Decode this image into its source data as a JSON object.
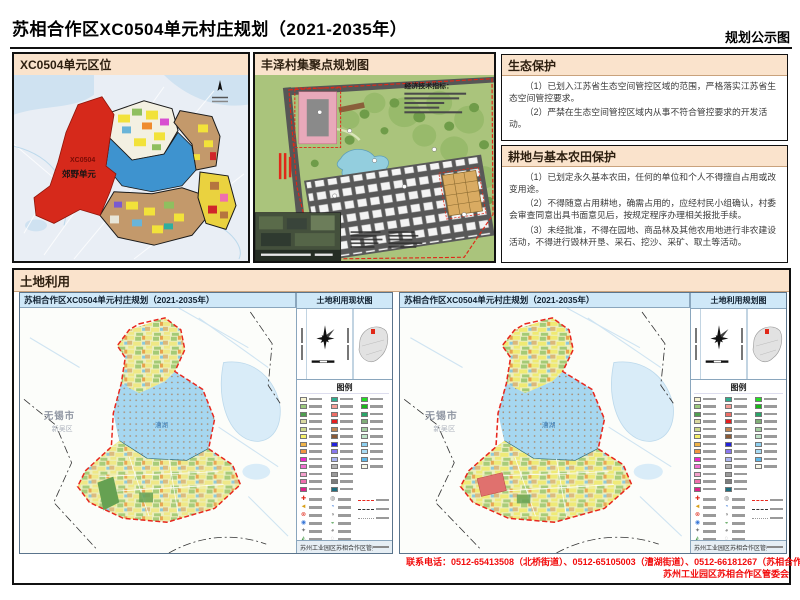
{
  "page": {
    "title": "苏相合作区XC0504单元村庄规划（2021-2035年）",
    "corner_label": "规划公示图"
  },
  "location_panel": {
    "title": "XC0504单元区位",
    "unit_label": "XC0504",
    "unit_sublabel": "郊野单元"
  },
  "fengze_panel": {
    "title": "丰泽村集聚点规划图",
    "indicator_title": "经济技术指标："
  },
  "eco_section": {
    "title": "生态保护",
    "paragraphs": [
      "（1）已划入江苏省生态空间管控区域的范围，严格落实江苏省生态空间管控要求。",
      "（2）严禁在生态空间管控区域内从事不符合管控要求的开发活动。"
    ]
  },
  "farmland_section": {
    "title": "耕地与基本农田保护",
    "paragraphs": [
      "（1）已划定永久基本农田，任何的单位和个人不得擅自占用或改变用途。",
      "（2）不得随意占用耕地，确需占用的，应经村民小组确认，村委会审查同意出具书面意见后，按规定程序办理相关报批手续。",
      "（3）未经批准，不得在园地、商品林及其他农用地进行非农建设活动，不得进行毁林开垦、采石、挖沙、采矿、取土等活动。"
    ]
  },
  "landuse_section": {
    "title": "土地利用",
    "maps": [
      {
        "title": "苏相合作区XC0504单元村庄规划（2021-2035年）",
        "corner_label": "土地利用现状图",
        "city_label": "无锡市",
        "district_label": "新吴区",
        "lake_label": "漕湖",
        "footer_text": "苏州工业园区苏相合作区管委会"
      },
      {
        "title": "苏相合作区XC0504单元村庄规划（2021-2035年）",
        "corner_label": "土地利用规划图",
        "city_label": "无锡市",
        "district_label": "新吴区",
        "lake_label": "漕湖",
        "footer_text": "苏州工业园区苏相合作区管委会"
      }
    ],
    "legend": {
      "title": "图例",
      "col1": [
        "#f7f3cf",
        "#9cc97e",
        "#4f9e50",
        "#d9d9a0",
        "#cdd98a",
        "#f5f06a",
        "#f0b44a",
        "#f2953f",
        "#ee28c8",
        "#f06fd0",
        "#f3a0cc",
        "#ef6fae",
        "#e0218a"
      ],
      "col2": [
        "#2fae8f",
        "#f59d96",
        "#ef6e66",
        "#e51f1f",
        "#c08552",
        "#8a5a36",
        "#2222dd",
        "#8877ee",
        "#aab4f0",
        "#b3b3b3",
        "#9a9a9a",
        "#7d7d7d",
        "#1f6f80"
      ],
      "col3": [
        "#22e022",
        "#18b818",
        "#29a568",
        "#7fae77",
        "#a4cfa0",
        "#bfe3c8",
        "#8ed0f0",
        "#a9dcf5",
        "#5fb8e8",
        "#f7f7e8"
      ],
      "point_symbols": [
        {
          "glyph": "✚",
          "color": "#e02818"
        },
        {
          "glyph": "◄",
          "color": "#d8a018"
        },
        {
          "glyph": "⊗",
          "color": "#e02818"
        },
        {
          "glyph": "◉",
          "color": "#3a78d8"
        },
        {
          "glyph": "✦",
          "color": "#777777"
        },
        {
          "glyph": "◭",
          "color": "#4a9a4a"
        }
      ],
      "point_symbols2": [
        {
          "glyph": "◍",
          "color": "#888888"
        },
        {
          "glyph": "◔",
          "color": "#3a78d8"
        },
        {
          "glyph": "◑",
          "color": "#888888"
        },
        {
          "glyph": "◒",
          "color": "#4a9a4a"
        },
        {
          "glyph": "◕",
          "color": "#888888"
        },
        {
          "glyph": "◌",
          "color": "#888888"
        }
      ],
      "boundary_lines": [
        {
          "color": "#e8281e",
          "style": "dashed"
        },
        {
          "color": "#333333",
          "style": "dashed"
        },
        {
          "color": "#999999",
          "style": "dotted"
        }
      ]
    }
  },
  "contact": {
    "line1": "联系电话：0512-65413508（北桥街道）、0512-65105003（漕湖街道）、0512-66181267（苏相合作区）",
    "line2": "苏州工业园区苏相合作区管委会"
  },
  "colors": {
    "panel_header_bg": "#fae3cc",
    "map_title_bg": "#cfe8f8",
    "unit_red": "#d6291b",
    "lake_blue": "#a6d7f0",
    "contact_red": "#f20d0d"
  }
}
